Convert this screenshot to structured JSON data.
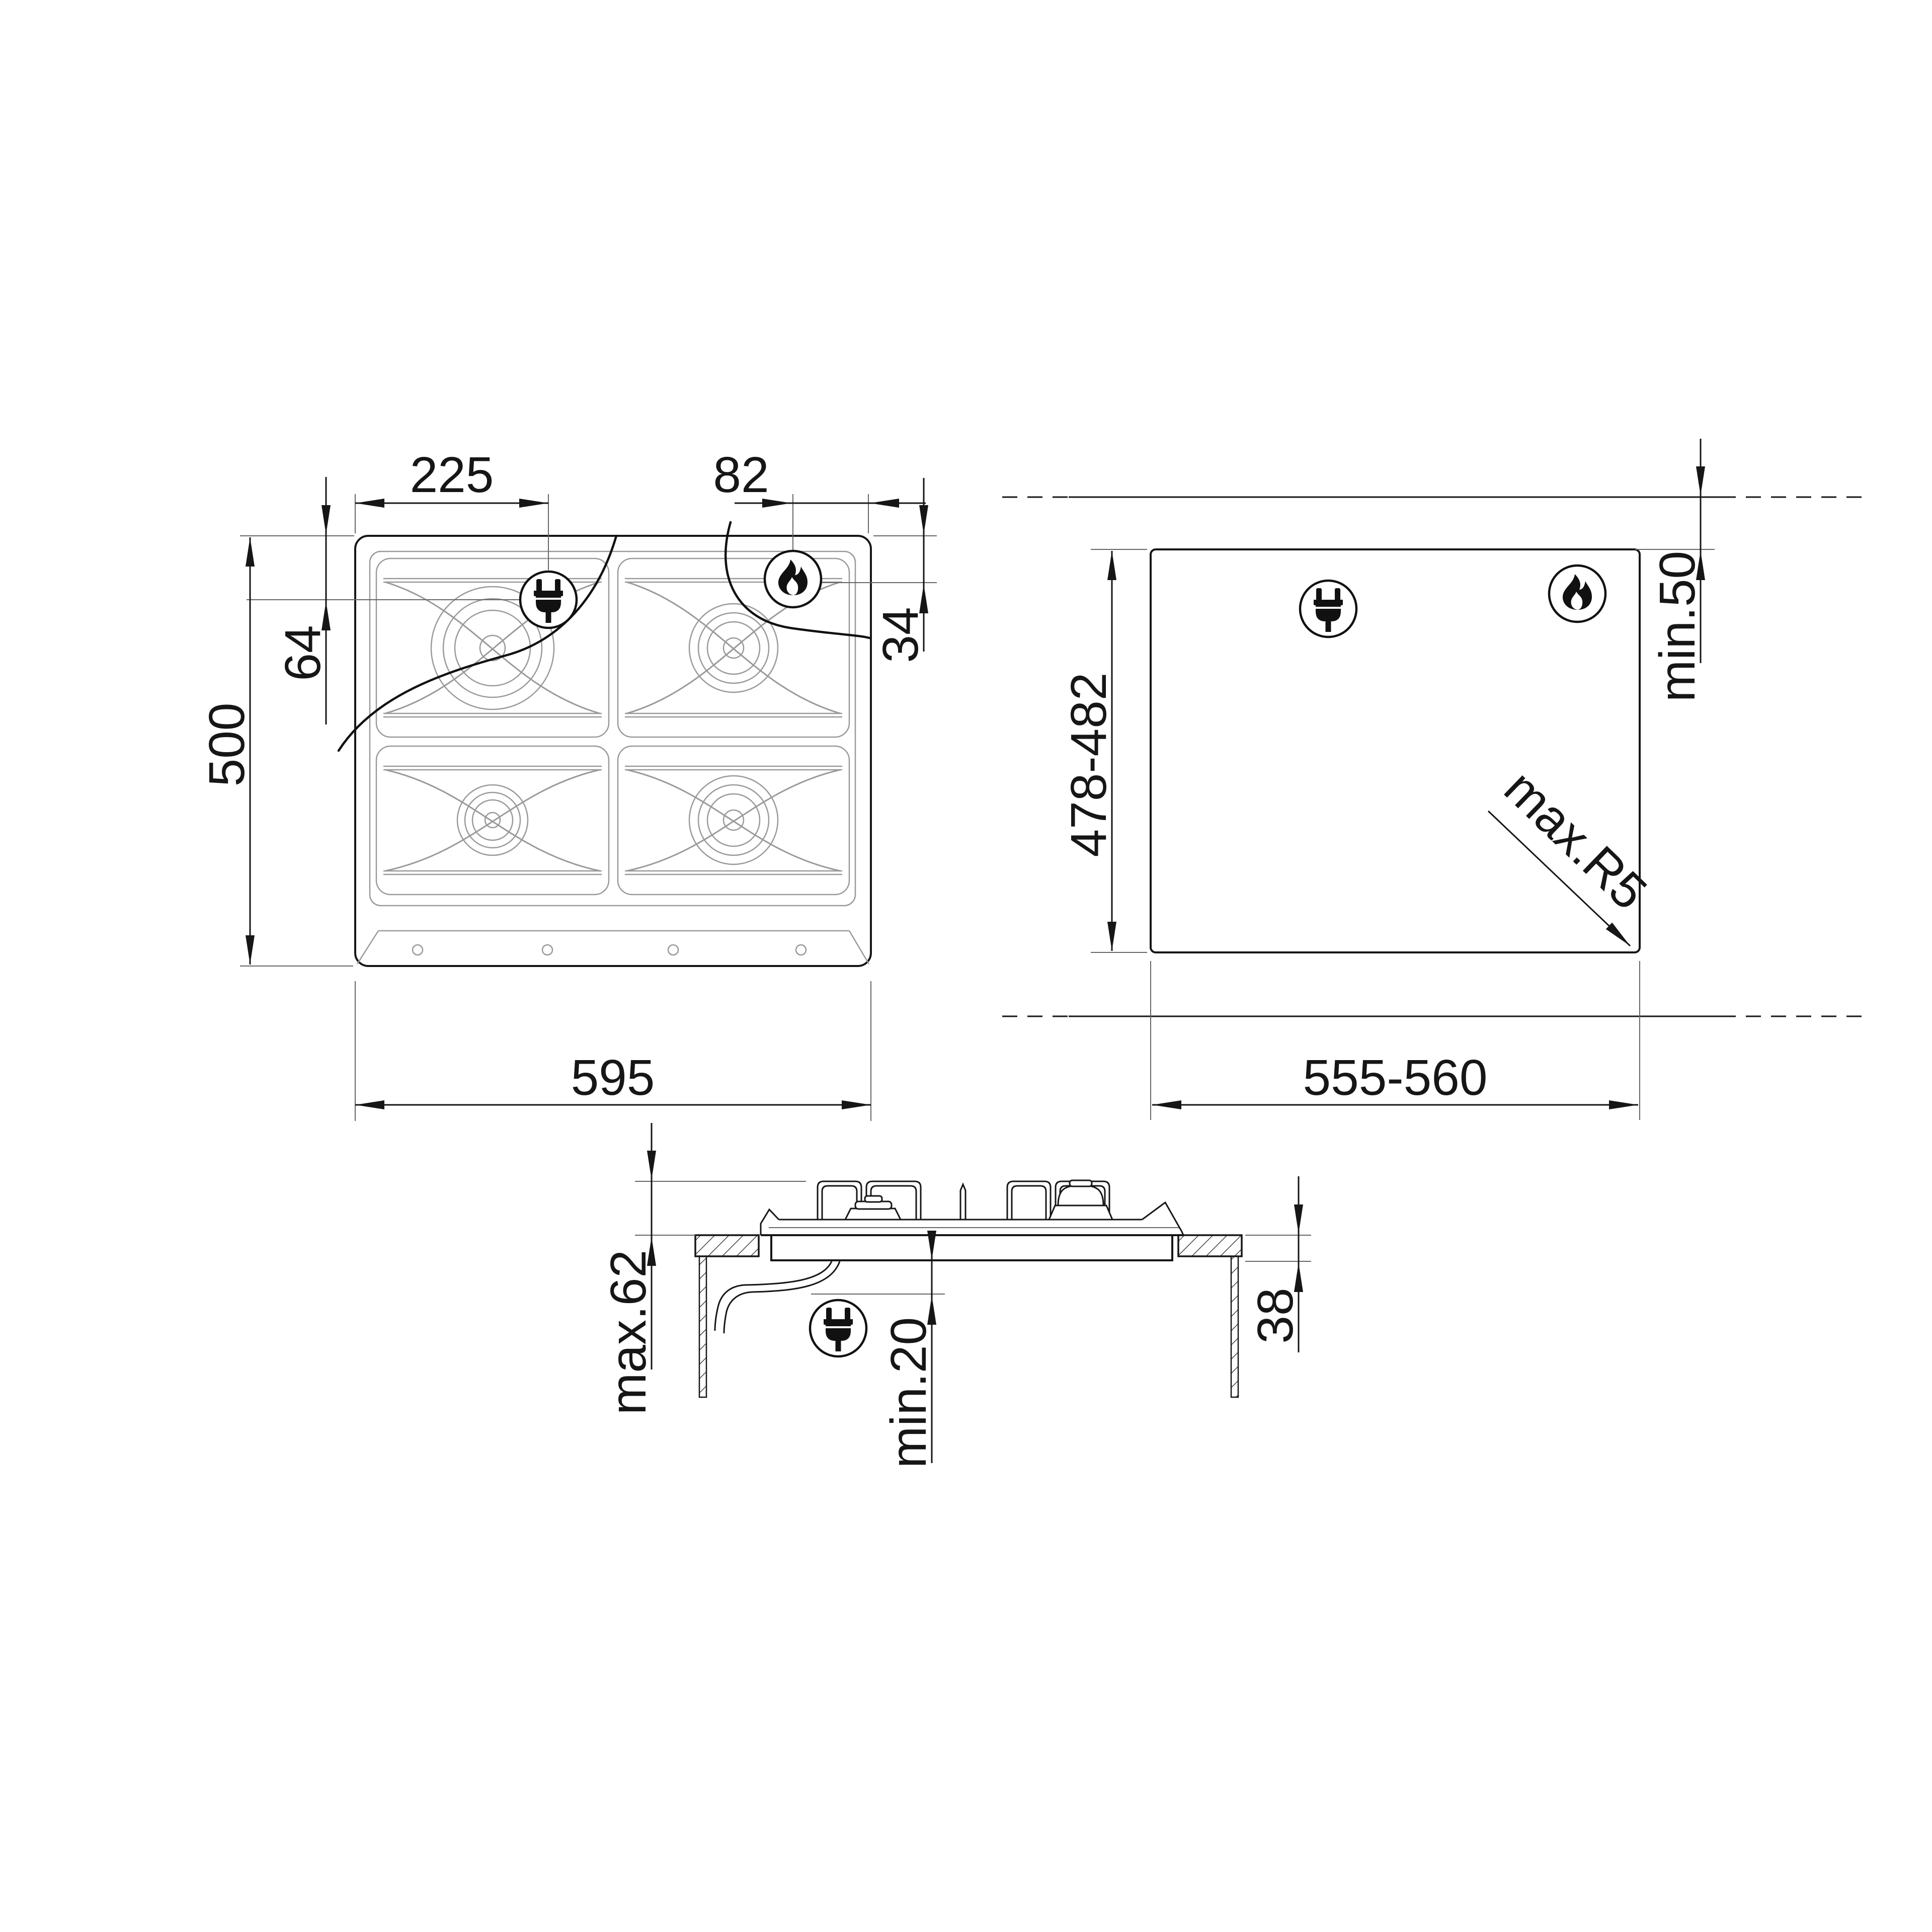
{
  "labels": {
    "plan": {
      "plug_from_left": "225",
      "flame_from_right": "82",
      "plug_from_top": "64",
      "hob_depth": "500",
      "flame_from_top": "34",
      "hob_width": "595"
    },
    "cutout": {
      "depth_range": "478-482",
      "width_range": "555-560",
      "rear_clearance": "min.50",
      "corner_radius": "max.R5"
    },
    "section": {
      "height_above_worktop": "max.62",
      "clearance_below": "min.20",
      "worktop_thickness": "38"
    }
  },
  "icons": {
    "plug": "power-plug-icon",
    "flame": "gas-flame-icon"
  },
  "colors": {
    "line": "#161616",
    "grid": "#9a9a9a",
    "extension": "#666666",
    "background": "#ffffff"
  }
}
